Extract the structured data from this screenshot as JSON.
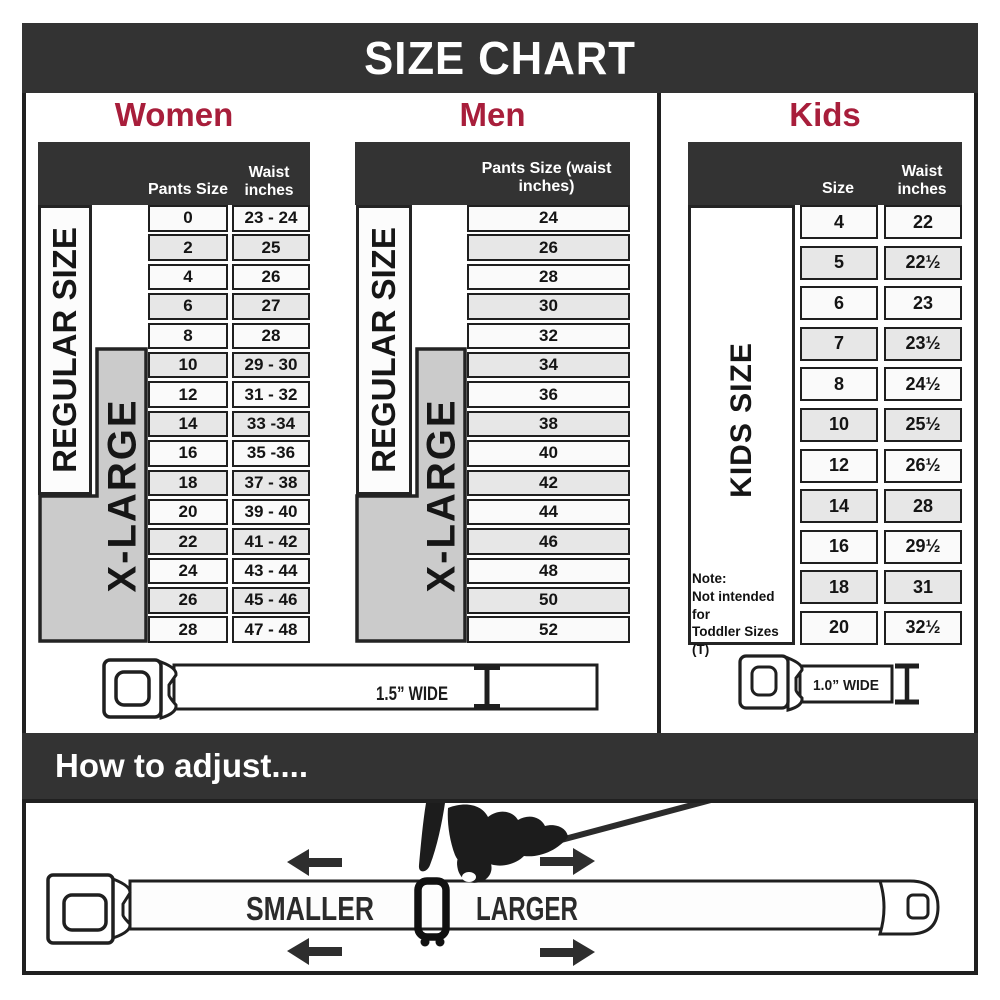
{
  "title": "SIZE CHART",
  "colors": {
    "header_bar": "#333333",
    "accent_red": "#A81E3B",
    "band_gray": "#cbcbcb",
    "row_light": "#fafafa",
    "row_alt": "#e7e7e7"
  },
  "chart_data": [
    {
      "type": "table",
      "title": "Women",
      "columns": [
        "Pants Size",
        "Waist inches"
      ],
      "size_bands": [
        "REGULAR SIZE",
        "X-LARGE"
      ],
      "rows": [
        [
          "0",
          "23 - 24"
        ],
        [
          "2",
          "25"
        ],
        [
          "4",
          "26"
        ],
        [
          "6",
          "27"
        ],
        [
          "8",
          "28"
        ],
        [
          "10",
          "29 - 30"
        ],
        [
          "12",
          "31 - 32"
        ],
        [
          "14",
          "33 -34"
        ],
        [
          "16",
          "35 -36"
        ],
        [
          "18",
          "37 - 38"
        ],
        [
          "20",
          "39 - 40"
        ],
        [
          "22",
          "41 - 42"
        ],
        [
          "24",
          "43 - 44"
        ],
        [
          "26",
          "45 - 46"
        ],
        [
          "28",
          "47 - 48"
        ]
      ]
    },
    {
      "type": "table",
      "title": "Men",
      "columns": [
        "Pants Size (waist inches)"
      ],
      "size_bands": [
        "REGULAR SIZE",
        "X-LARGE"
      ],
      "rows": [
        "24",
        "26",
        "28",
        "30",
        "32",
        "34",
        "36",
        "38",
        "40",
        "42",
        "44",
        "46",
        "48",
        "50",
        "52"
      ]
    },
    {
      "type": "table",
      "title": "Kids",
      "columns": [
        "Size",
        "Waist inches"
      ],
      "size_bands": [
        "KIDS SIZE"
      ],
      "note_lines": [
        "Note:",
        "Not intended for",
        "Toddler Sizes (T)"
      ],
      "rows": [
        [
          "4",
          "22"
        ],
        [
          "5",
          "22½"
        ],
        [
          "6",
          "23"
        ],
        [
          "7",
          "23½"
        ],
        [
          "8",
          "24½"
        ],
        [
          "10",
          "25½"
        ],
        [
          "12",
          "26½"
        ],
        [
          "14",
          "28"
        ],
        [
          "16",
          "29½"
        ],
        [
          "18",
          "31"
        ],
        [
          "20",
          "32½"
        ]
      ]
    }
  ],
  "belts": {
    "adult_width_label": "1.5” WIDE",
    "kids_width_label": "1.0” WIDE"
  },
  "how_to_adjust": {
    "heading": "How to adjust....",
    "smaller_label": "SMALLER",
    "larger_label": "LARGER"
  }
}
